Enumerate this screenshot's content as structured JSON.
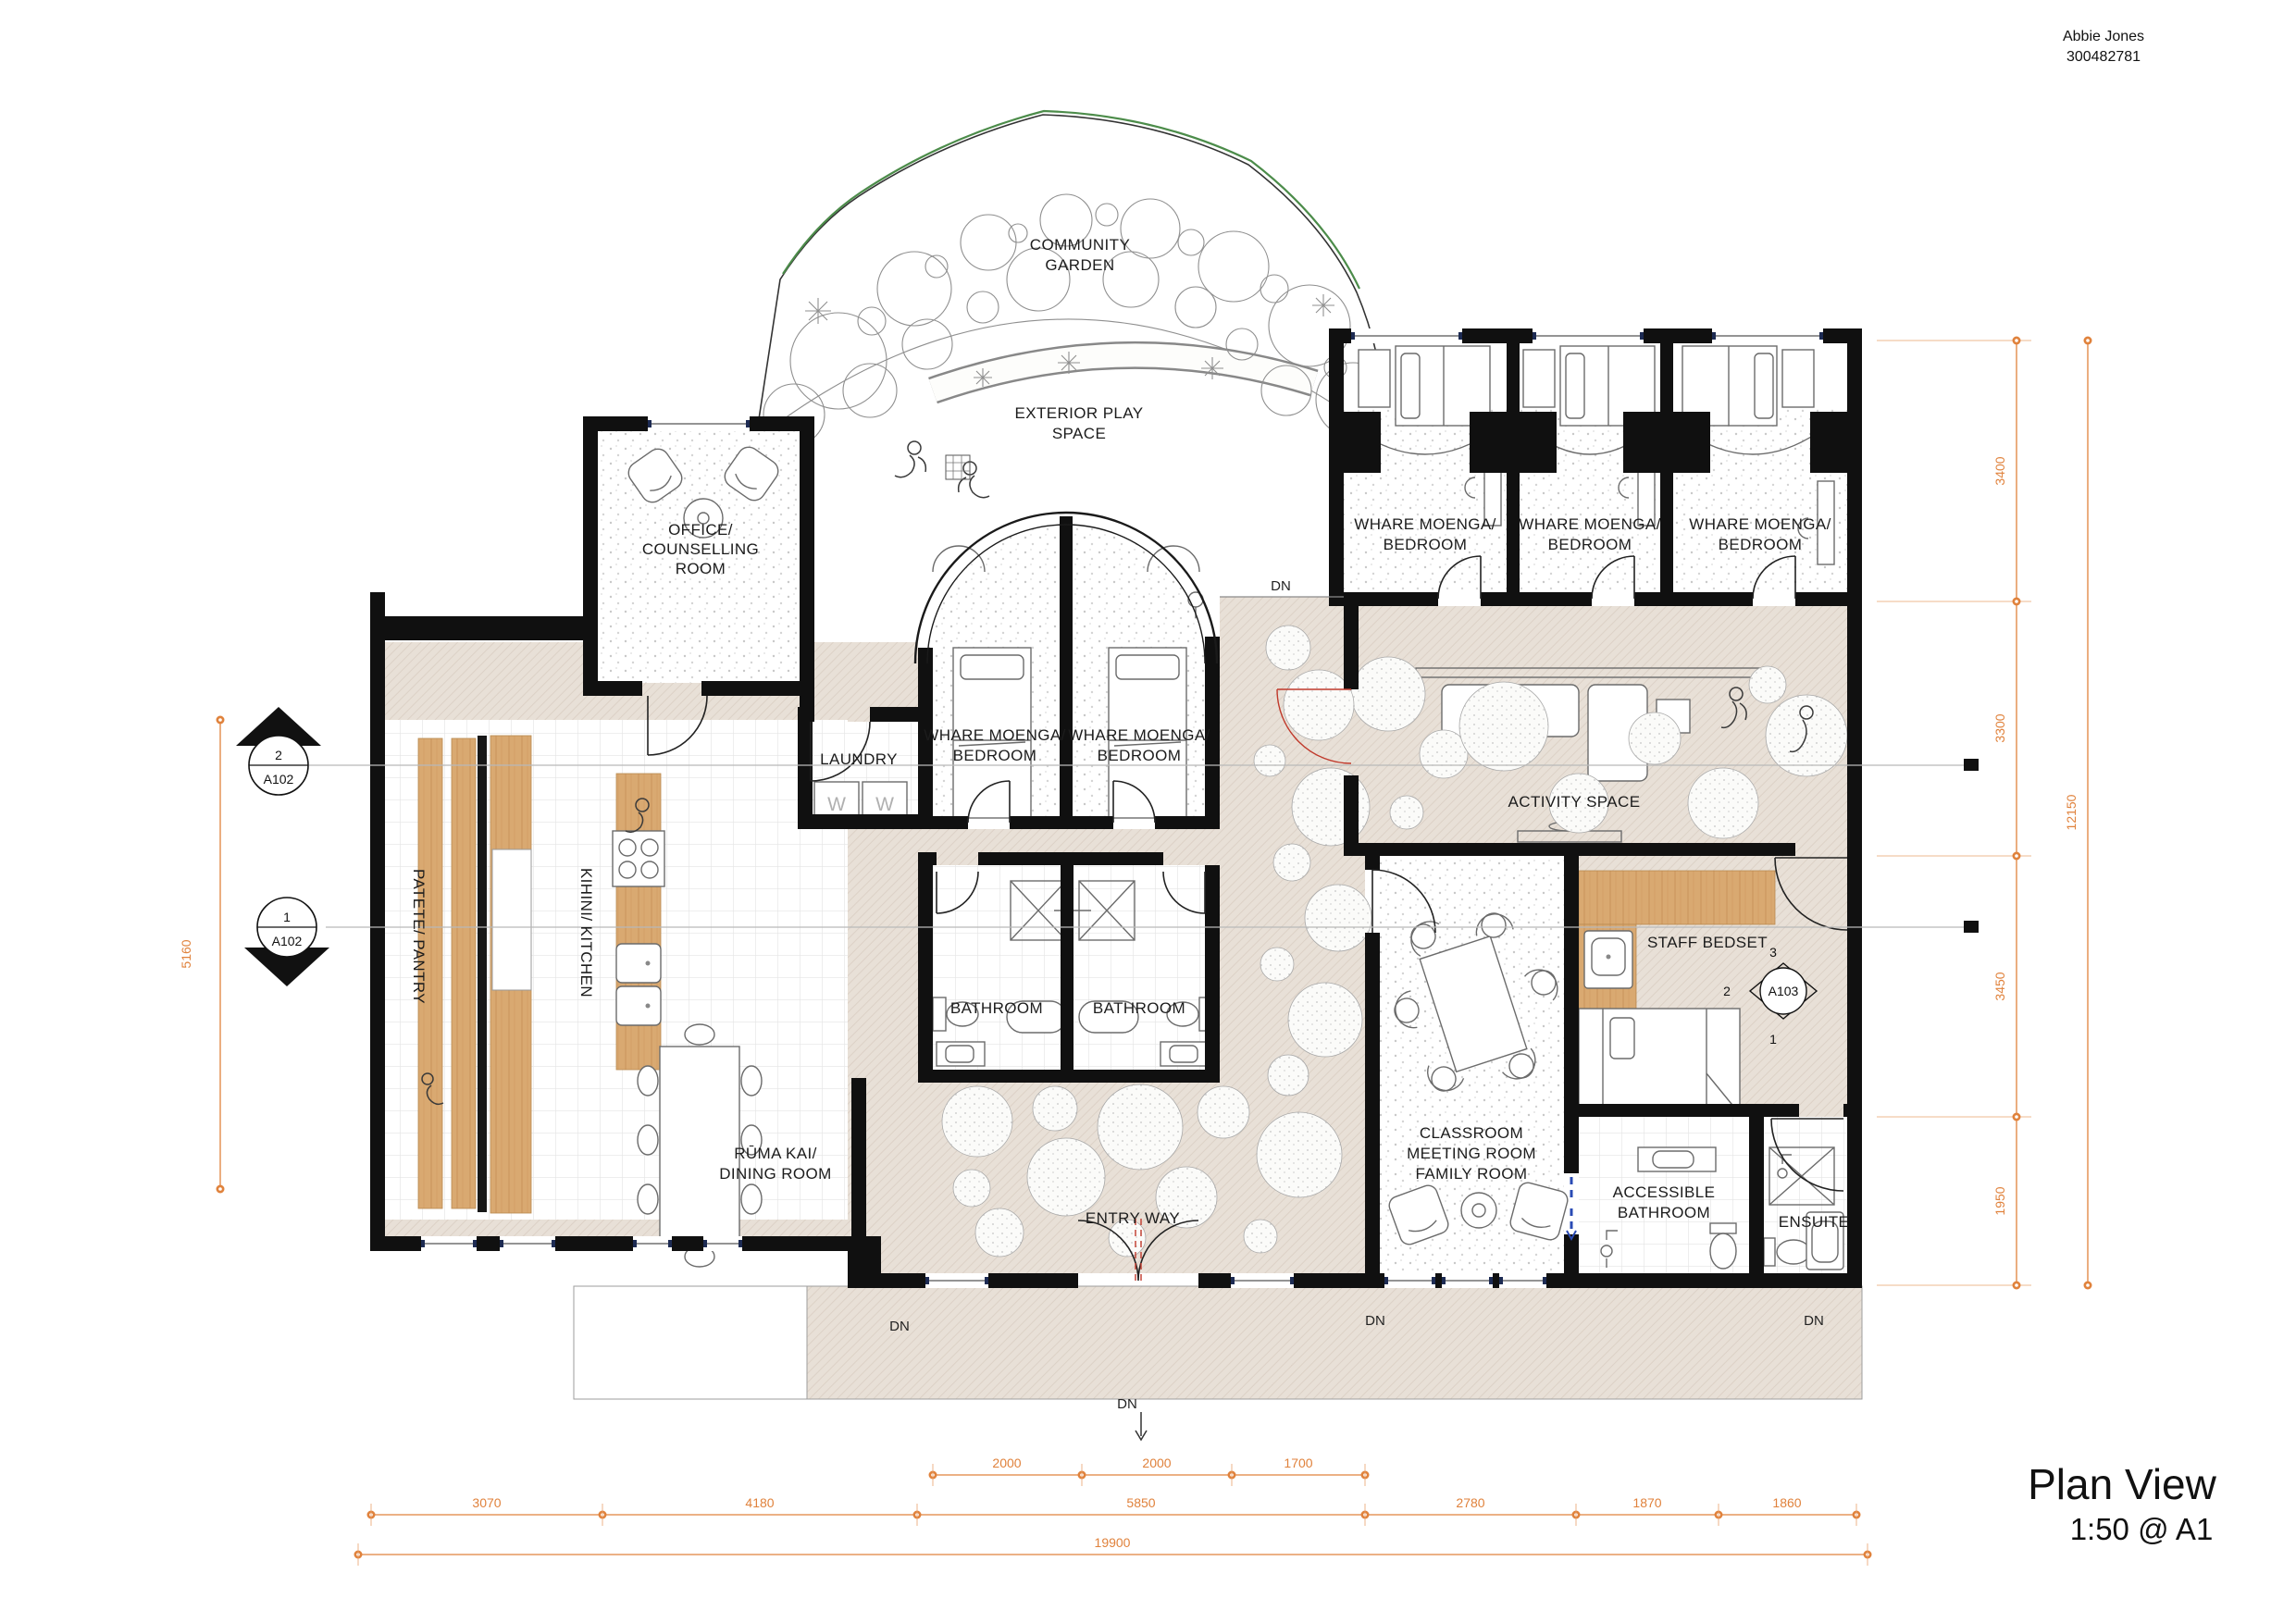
{
  "header": {
    "author": "Abbie Jones",
    "student_id": "300482781"
  },
  "title_block": {
    "title": "Plan View",
    "scale": "1:50 @ A1"
  },
  "rooms": {
    "community_garden": [
      "COMMUNITY",
      "GARDEN"
    ],
    "exterior_play": [
      "EXTERIOR PLAY",
      "SPACE"
    ],
    "office": [
      "OFFICE/",
      "COUNSELLING",
      "ROOM"
    ],
    "bedroom_arc_left": [
      "WHARE MOENGA/",
      "BEDROOM"
    ],
    "bedroom_arc_right": [
      "WHARE MOENGA/",
      "BEDROOM"
    ],
    "bedroom_1": [
      "WHARE MOENGA/",
      "BEDROOM"
    ],
    "bedroom_2": [
      "WHARE MOENGA/",
      "BEDROOM"
    ],
    "bedroom_3": [
      "WHARE MOENGA/",
      "BEDROOM"
    ],
    "laundry": "LAUNDRY",
    "washer_left": "W",
    "washer_right": "W",
    "pantry": "PATETE/ PANTRY",
    "kitchen": "KIHINI/ KITCHEN",
    "dining": [
      "RŪMA KAI/",
      "DINING ROOM"
    ],
    "bathroom_left": "BATHROOM",
    "bathroom_right": "BATHROOM",
    "entry": "ENTRY WAY",
    "activity": "ACTIVITY SPACE",
    "staff_bedset": "STAFF BEDSET",
    "classroom": [
      "CLASSROOM",
      "MEETING ROOM",
      "FAMILY ROOM"
    ],
    "accessible_bathroom": [
      "ACCESSIBLE",
      "BATHROOM"
    ],
    "ensuite": "ENSUITE"
  },
  "stairs": {
    "dn": "DN"
  },
  "dimensions": {
    "right_column": [
      "3400",
      "3300",
      "3450",
      "1950"
    ],
    "right_total": "12150",
    "left": "5160",
    "bottom_top_row": [
      "2000",
      "2000",
      "1700"
    ],
    "bottom_mid_row": [
      "3070",
      "4180",
      "5850",
      "2780",
      "1870",
      "1860"
    ],
    "bottom_total": "19900"
  },
  "section_markers": {
    "m2": {
      "num": "2",
      "sheet": "A102"
    },
    "m1": {
      "num": "1",
      "sheet": "A102"
    },
    "a103": {
      "sheet": "A103",
      "top": "3",
      "left": "2",
      "bottom": "1"
    }
  },
  "colors": {
    "wall": "#101010",
    "floor_beige": "#E8E0D7",
    "wood": "#D9A971",
    "dimension_orange": "#E0823C",
    "glazing_navy": "#1d2b53",
    "garden_green": "#4c8c4a",
    "door_red": "#c0392b",
    "accessible_blue": "#2a4bb5"
  }
}
